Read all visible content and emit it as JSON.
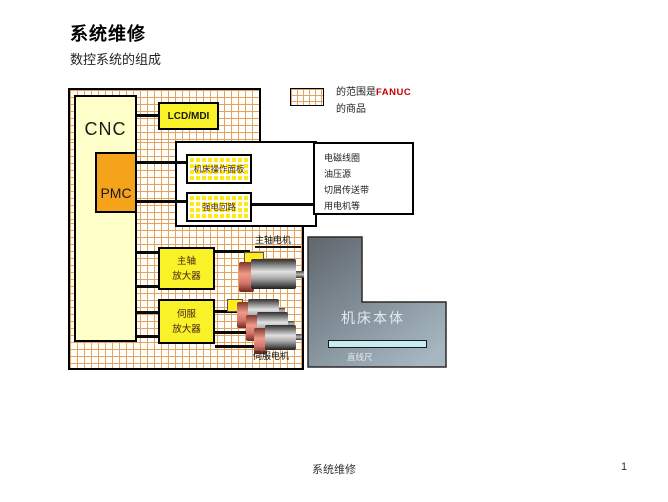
{
  "colors": {
    "grid_line": "#E2A263",
    "cream": "#FFFFC9",
    "orange": "#F5A31B",
    "yellow": "#FAF228",
    "hatch_yellow": "#FFE81A",
    "brand_red": "#C40000",
    "scale_cyan": "#C8EDF0",
    "machine_body_dark": "#5F666D",
    "machine_body_light": "#A6B7C2",
    "motor_salmon": "#E08070",
    "motor_gray": "#A8A8A8"
  },
  "slide": {
    "title": "系统维修",
    "subtitle": "数控系统的组成",
    "footer_text": "系统维修",
    "page_number": "1"
  },
  "diagram": {
    "cnc_label": "CNC",
    "pmc_label": "PMC",
    "lcd_mdi_label": "LCD/MDI",
    "operation_panel_label": "机床操作面板",
    "power_circuit_label": "强电回路",
    "spindle_amp": {
      "line1": "主轴",
      "line2": "放大器"
    },
    "servo_amp": {
      "line1": "伺服",
      "line2": "放大器"
    },
    "spindle_motor_label": "主轴电机",
    "servo_motor_label": "伺服电机",
    "machine_body_label": "机床本体",
    "linear_scale_label": "直线尺",
    "aux_equipment": {
      "items": [
        "电磁线圈",
        "油压源",
        "切屑传送带",
        "用电机等"
      ]
    },
    "legend": {
      "prefix": "的范围是",
      "brand": "FANUC",
      "suffix": "的商品"
    }
  }
}
